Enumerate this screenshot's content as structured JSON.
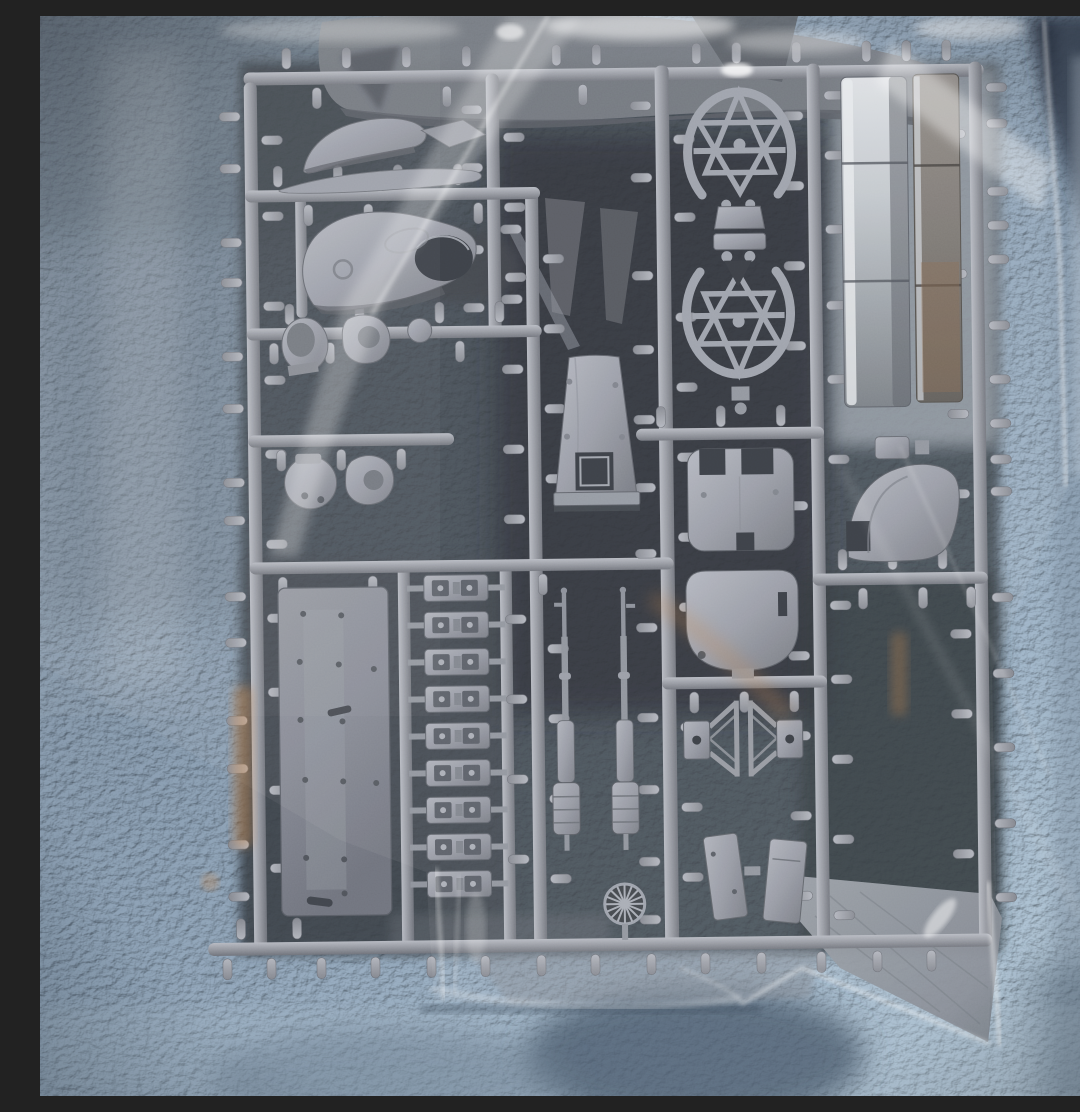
{
  "image": {
    "type": "photograph",
    "subject": "Gray injection-molded model kit sprue sealed inside a clear plastic bag",
    "surface": "light blue-gray fleece blanket",
    "plastic_color": "gray",
    "text_visible": "none"
  },
  "palette": {
    "blanket_top": "#6c7987",
    "blanket_mid": "#8093a6",
    "blanket_bottom": "#a9bcca",
    "blanket_navy_corner": "#262f3d",
    "blanket_shadow": "#475768",
    "bag_film": "#e9eff5",
    "bag_highlight": "#ffffff",
    "amber_reflection": "#c8884e",
    "amber_dim": "#8a6a4e",
    "sprue_plastic": "#999da6",
    "sprue_highlight": "#b7bac2",
    "sprue_shadow": "#6e7279",
    "interior_shadow": "#33373e",
    "background_part_gray": "#72767d",
    "opening_dark": "#34383f"
  },
  "sprue_contents": [
    {
      "name": "engine cowling upper half",
      "count": 1
    },
    {
      "name": "engine cowling lower half with round opening",
      "count": 1
    },
    {
      "name": "curved blade",
      "count": 1
    },
    {
      "name": "oval lattice wheel frame",
      "count": 2
    },
    {
      "name": "drum / cap part",
      "count": 5
    },
    {
      "name": "long fuselage side panel strip",
      "count": 2
    },
    {
      "name": "keystone bulkhead panel with window",
      "count": 1
    },
    {
      "name": "notched bulkhead panel",
      "count": 1
    },
    {
      "name": "rounded bulkhead panel",
      "count": 1
    },
    {
      "name": "curved fairing",
      "count": 1
    },
    {
      "name": "deck plate with rivets",
      "count": 1
    },
    {
      "name": "track link / hinge strip",
      "count": 9
    },
    {
      "name": "machine gun with drum magazine",
      "count": 2
    },
    {
      "name": "triangular strut frame",
      "count": 2
    },
    {
      "name": "multi-spoke wheel disc",
      "count": 1
    },
    {
      "name": "small hatch panel",
      "count": 2
    },
    {
      "name": "loose wing panel behind sprue",
      "count": 2
    },
    {
      "name": "loose fuselage half behind sprue",
      "count": 1
    }
  ]
}
